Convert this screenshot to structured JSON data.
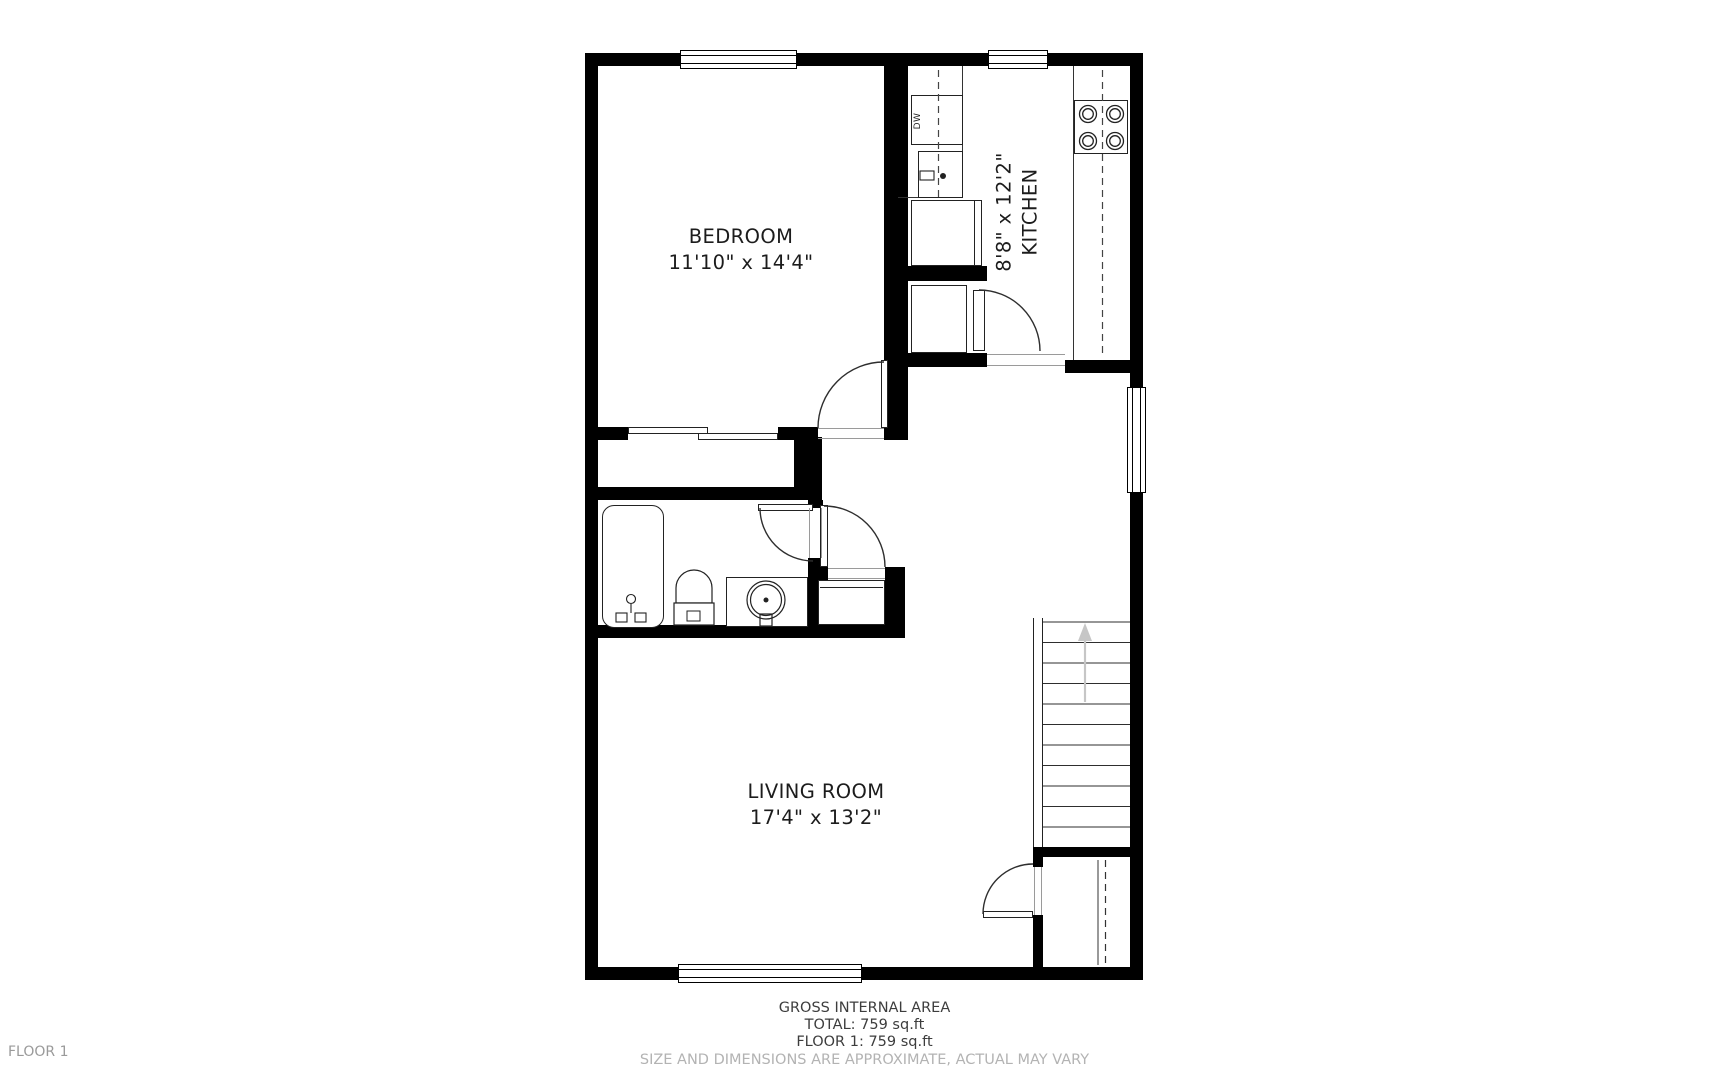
{
  "floor": {
    "label": "FLOOR 1"
  },
  "rooms": [
    {
      "name": "BEDROOM",
      "dimensions": "11'10\" x 14'4\""
    },
    {
      "name": "KITCHEN",
      "dimensions": "8'8\" x 12'2\""
    },
    {
      "name": "LIVING ROOM",
      "dimensions": "17'4\" x 13'2\""
    }
  ],
  "appliances": {
    "dishwasher": "DW"
  },
  "footer": {
    "title": "GROSS INTERNAL AREA",
    "total": "TOTAL: 759 sq.ft",
    "floor_area": "FLOOR 1: 759 sq.ft",
    "disclaimer": "SIZE AND DIMENSIONS ARE APPROXIMATE, ACTUAL MAY VARY"
  },
  "colors": {
    "wall": "#000000",
    "line": "#2e2e2e",
    "muted_text": "#b3b3b3",
    "floor_text": "#9a9a9a",
    "arrow": "#c6c6c6"
  }
}
